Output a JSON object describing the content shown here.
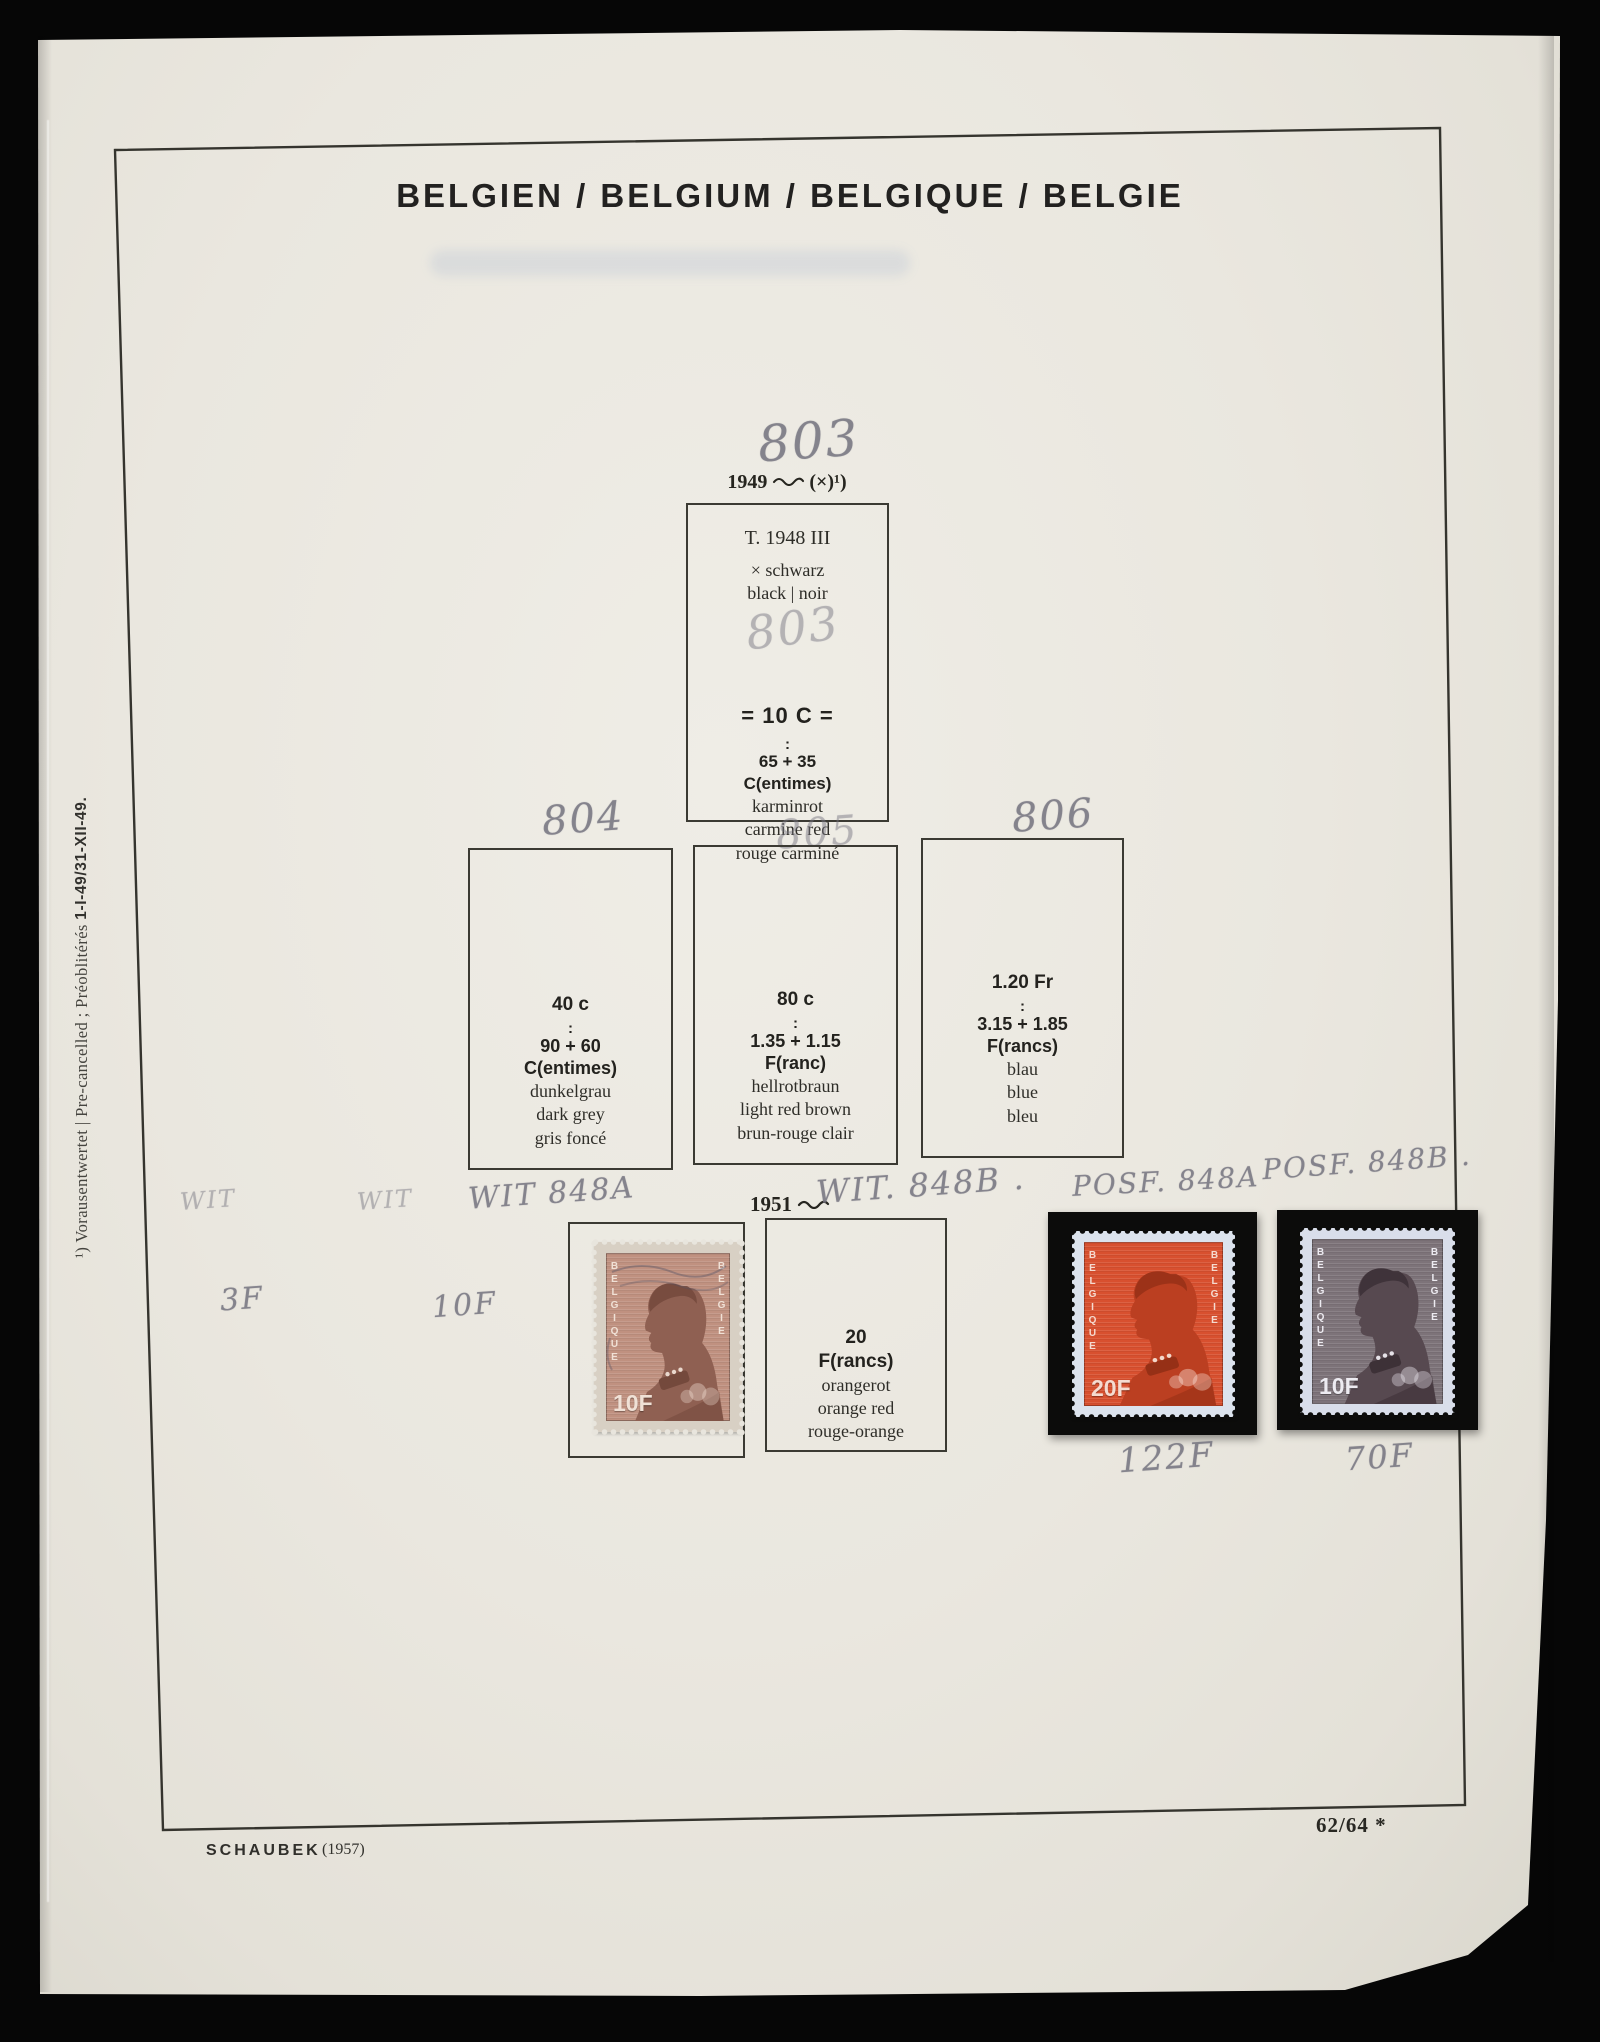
{
  "title": "BELGIEN / BELGIUM / BELGIQUE / BELGIE",
  "margin_note": {
    "text": "¹) Vorausentwertet | Pre-cancelled ; Préoblitérés",
    "dates": "1-I-49/31-XII-49."
  },
  "captions": {
    "c1949": {
      "year": "1949",
      "suffix": "(×)¹)"
    },
    "c1951": {
      "year": "1951"
    }
  },
  "handwritten": {
    "n803": "803",
    "n803_faint": "803",
    "n804": "804",
    "n805": "805",
    "n806": "806",
    "wit_a": "WIT",
    "wit_b": "WIT",
    "wit_848a": "WIT 848A",
    "wit_848b": "WIT. 848B .",
    "posf_848a": "POSF. 848A",
    "posf_848b": "POSF. 848B .",
    "price_3f": "3F",
    "price_10f": "10F",
    "price_122f": "122F",
    "price_70f": "70F"
  },
  "box803": {
    "type_line": "T. 1948 III",
    "overprint_de": "× schwarz",
    "overprint_en_fr": "black | noir",
    "denomination": "= 10 C =",
    "colon": ":",
    "face_value": "65 + 35",
    "currency": "C(entimes)",
    "colors": [
      "karminrot",
      "carmine red",
      "rouge carminé"
    ]
  },
  "box804": {
    "denomination": "40 c",
    "colon": ":",
    "face_value": "90 + 60",
    "currency": "C(entimes)",
    "colors": [
      "dunkelgrau",
      "dark grey",
      "gris foncé"
    ]
  },
  "box805": {
    "denomination": "80 c",
    "colon": ":",
    "face_value": "1.35 + 1.15",
    "currency": "F(ranc)",
    "colors": [
      "hellrotbraun",
      "light red brown",
      "brun-rouge clair"
    ]
  },
  "box806": {
    "denomination": "1.20 Fr",
    "colon": ":",
    "face_value": "3.15 + 1.85",
    "currency": "F(rancs)",
    "colors": [
      "blau",
      "blue",
      "bleu"
    ]
  },
  "box848b": {
    "denomination": "20",
    "currency": "F(rancs)",
    "colors": [
      "orangerot",
      "orange red",
      "rouge-orange"
    ]
  },
  "stamps": {
    "s848a_used": {
      "country_left": "BELGIQUE",
      "country_right": "BELGIE",
      "value": "10F",
      "color": "#c09180"
    },
    "s848a_mint": {
      "country_left": "BELGIQUE",
      "country_right": "BELGIE",
      "value": "20F",
      "color": "#d8502f"
    },
    "s848b_mint": {
      "country_left": "BELGIQUE",
      "country_right": "BELGIE",
      "value": "10F",
      "color": "#7d7379"
    }
  },
  "footer": {
    "publisher": "SCHAUBEK",
    "edition_year": "(1957)",
    "page_ref": "62/64 *"
  },
  "palette": {
    "paper": "#eae7df",
    "surround": "#060606",
    "pencil": "#84838c",
    "frame_line": "#35342e"
  }
}
